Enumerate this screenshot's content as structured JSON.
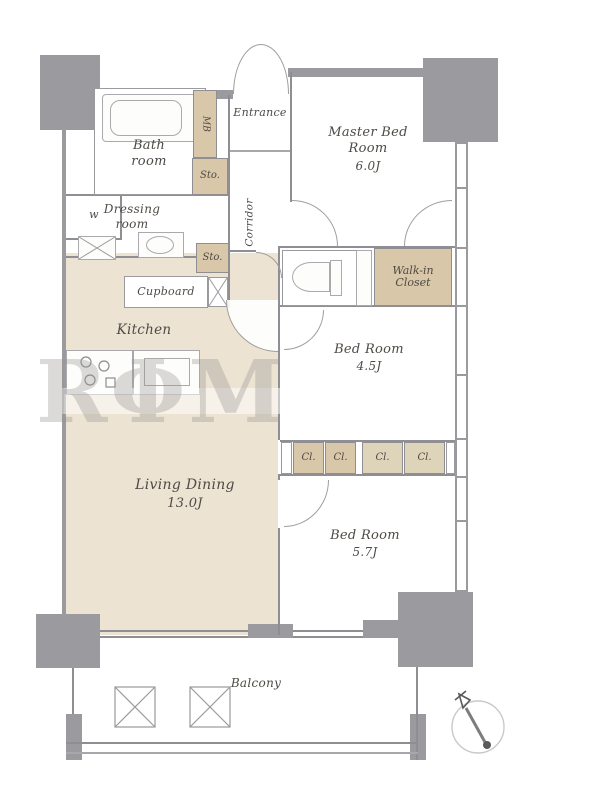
{
  "rooms": {
    "master_bed": {
      "name": "Master Bed Room",
      "size": "6.0J"
    },
    "bed_45": {
      "name": "Bed Room",
      "size": "4.5J"
    },
    "bed_57": {
      "name": "Bed Room",
      "size": "5.7J"
    },
    "living_dining": {
      "name": "Living Dining",
      "size": "13.0J"
    },
    "kitchen": {
      "name": "Kitchen"
    },
    "bath": {
      "name": "Bath room"
    },
    "dressing": {
      "name": "Dressing room"
    },
    "entrance": {
      "name": "Entrance"
    },
    "corridor": {
      "name": "Corridor"
    },
    "balcony": {
      "name": "Balcony"
    },
    "washroom": {
      "name": "w"
    }
  },
  "storage": {
    "sto": "Sto.",
    "cl": "Cl.",
    "cupboard": "Cupboard",
    "walk_in_closet": "Walk-in Closet",
    "meter_box": "MB"
  },
  "watermark": "RΦM",
  "colors": {
    "wall_gray": "#9b9b9f",
    "floor_beige": "#ece3d2",
    "storage_tan": "#d8c7a8",
    "label_ink": "#4e4a45"
  }
}
